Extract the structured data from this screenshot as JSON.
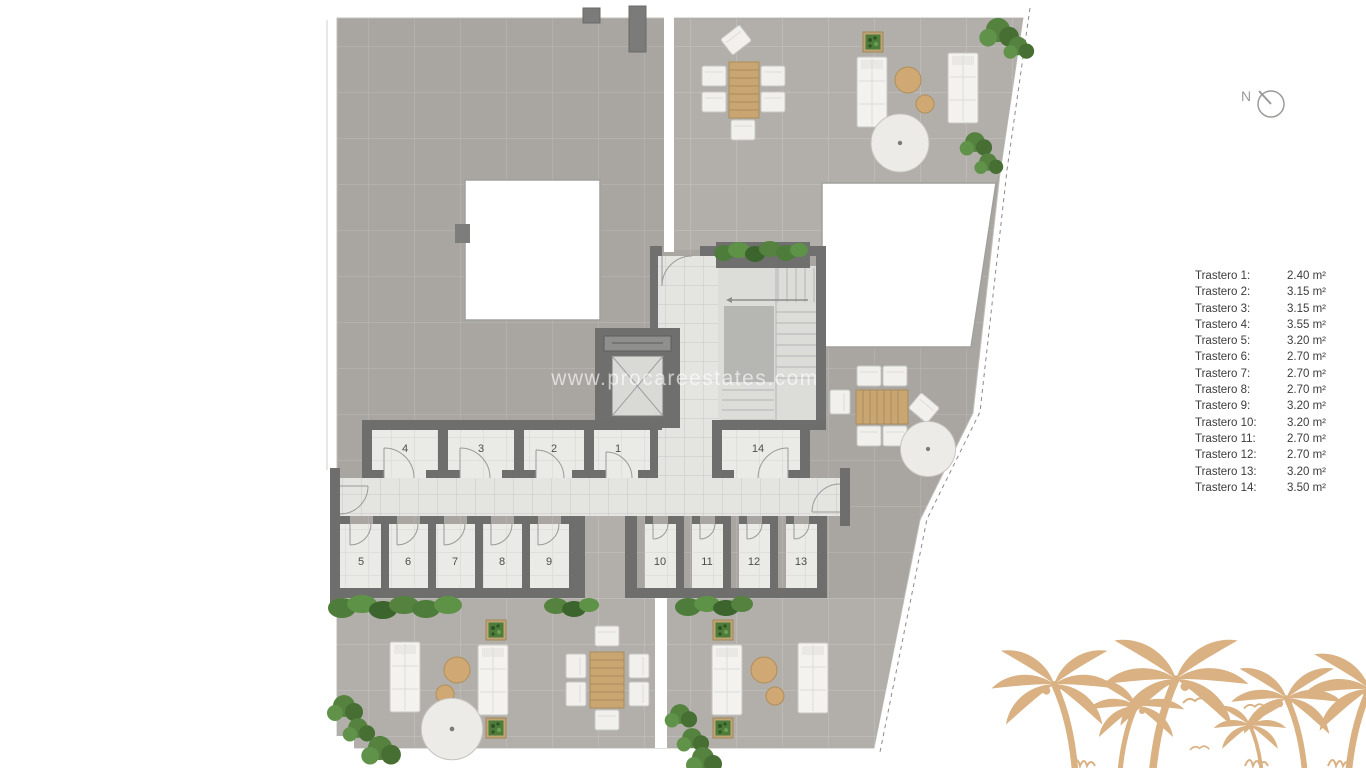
{
  "plan": {
    "watermark": "www.procareestates.com",
    "compass_label": "N",
    "rooms": [
      "1",
      "2",
      "3",
      "4",
      "5",
      "6",
      "7",
      "8",
      "9",
      "10",
      "11",
      "12",
      "13",
      "14"
    ],
    "colors": {
      "wall": "#6e6e6c",
      "roof_tile": "#a9a6a2",
      "terrace_tile": "#b2afab",
      "corridor_floor": "#e4e4e1",
      "room_floor": "#eaeae7",
      "wood": "#c9a671",
      "plant_green": "#53813f",
      "palm_tan": "#d9b183",
      "legend_text": "#3c3c3c"
    }
  },
  "legend": {
    "items": [
      {
        "label": "Trastero 1:",
        "value": "2.40 m²"
      },
      {
        "label": "Trastero 2:",
        "value": "3.15 m²"
      },
      {
        "label": "Trastero 3:",
        "value": "3.15 m²"
      },
      {
        "label": "Trastero 4:",
        "value": "3.55 m²"
      },
      {
        "label": "Trastero 5:",
        "value": "3.20 m²"
      },
      {
        "label": "Trastero 6:",
        "value": "2.70 m²"
      },
      {
        "label": "Trastero 7:",
        "value": "2.70 m²"
      },
      {
        "label": "Trastero 8:",
        "value": "2.70 m²"
      },
      {
        "label": "Trastero 9:",
        "value": "3.20 m²"
      },
      {
        "label": "Trastero 10:",
        "value": "3.20 m²"
      },
      {
        "label": "Trastero 11:",
        "value": "2.70 m²"
      },
      {
        "label": "Trastero 12:",
        "value": "2.70 m²"
      },
      {
        "label": "Trastero 13:",
        "value": "3.20 m²"
      },
      {
        "label": "Trastero 14:",
        "value": "3.50 m²"
      }
    ]
  }
}
